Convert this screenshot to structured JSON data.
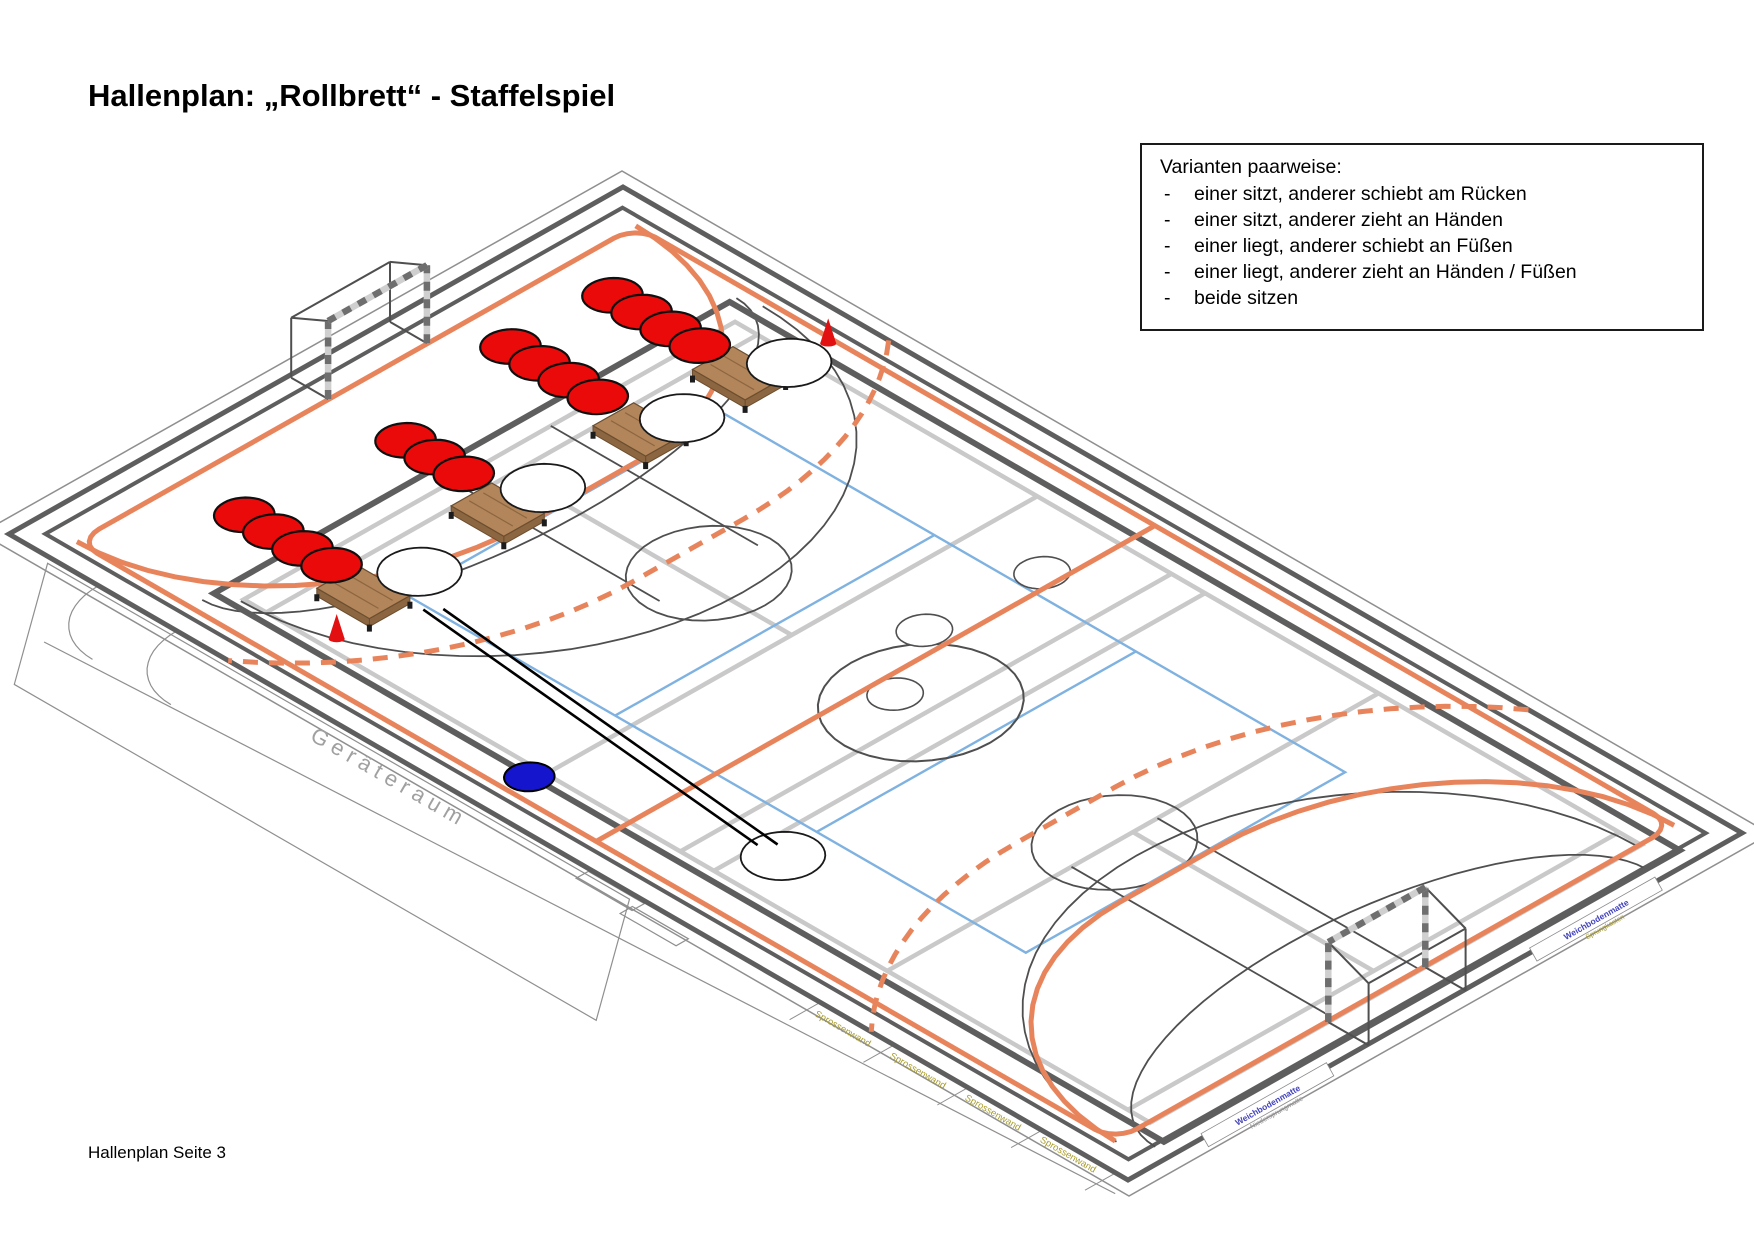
{
  "title": "Hallenplan: „Rollbrett“ - Staffelspiel",
  "footer": "Hallenplan Seite 3",
  "variants": {
    "title": "Varianten paarweise:",
    "items": [
      "einer sitzt, anderer schiebt am Rücken",
      "einer sitzt, anderer zieht an Händen",
      "einer liegt, anderer schiebt an Füßen",
      "einer liegt, anderer zieht an Händen / Füßen",
      "beide sitzen"
    ]
  },
  "labels": {
    "geraeteraum": "Geräteraum",
    "sprossenwand": "Sprossenwand",
    "right_wall": [
      {
        "main": "Weichbodenmatte",
        "sub": "Niedersprungmatte"
      },
      {
        "main": "Weichbodenmatte",
        "sub": "Sprungkasten"
      }
    ]
  },
  "scene": {
    "origin": [
      623,
      187
    ],
    "axis_u": [
      1119,
      646
    ],
    "axis_v": [
      -614,
      347
    ],
    "colors": {
      "wall": "#5E5E5E",
      "thin_outline": "#8F8F8F",
      "court_gray": "#C9C9C9",
      "court_blue": "#7FB2E0",
      "bball": "#4F4F4F",
      "handball": "#E8845C",
      "field": "#5E5E5E",
      "red": "#EA0A0A",
      "dot_stroke": "#101010",
      "wood": "#B3855A",
      "wood_dark": "#8C6640",
      "wood_line": "#6B4E30",
      "cone": "#E21010",
      "ball": "#1515CD",
      "board_fill": "#FFFFFF",
      "board_stroke": "#1A1A1A",
      "label_gray": "#A0A0A0",
      "label_olive": "#A89B2A",
      "label_blue": "#4343BE",
      "stripe_light": "#CFCFCF",
      "stripe_dark": "#6E6E6E",
      "arrow": "#000000"
    },
    "building": {
      "outer_rect": [
        -0.013,
        -0.022,
        1.013,
        1.022
      ],
      "band_line": [
        [
          0.1,
          1.125
        ],
        [
          1.005,
          1.03
        ]
      ],
      "room": [
        [
          0.04,
          1.01
        ],
        [
          0.56,
          1.01
        ],
        [
          0.64,
          1.21
        ],
        [
          0.12,
          1.21
        ]
      ],
      "door_arcs": [
        {
          "c": [
            0.135,
            1.0
          ],
          "ru": 0.055,
          "rv": 0.11
        },
        {
          "c": [
            0.205,
            1.0
          ],
          "ru": 0.055,
          "rv": 0.11
        }
      ],
      "mats": [
        [
          0.545,
          1.004,
          0.05,
          0.02
        ],
        [
          0.592,
          1.018,
          0.05,
          0.02
        ]
      ],
      "dividers_u": [
        0.725,
        0.791,
        0.857,
        0.923,
        0.989
      ],
      "divider_v": [
        1.0,
        1.05
      ]
    },
    "walls": {
      "outer": [
        0,
        0,
        1,
        1
      ],
      "inner": [
        0.016,
        0.03,
        0.984,
        0.97
      ]
    },
    "field_rect": [
      0.137,
      0.076,
      0.986,
      0.916
    ],
    "handball": {
      "court": [
        0.036,
        0.045,
        0.964,
        0.955
      ],
      "corner_r": [
        0.018,
        0.036
      ],
      "center_u": 0.5,
      "r6u": 0.185,
      "r9u": 0.277,
      "rv9": 0.545,
      "zones": [
        {
          "gu": 0.036,
          "dir": 1,
          "fv": [
            0.374,
            0.555
          ]
        },
        {
          "gu": 0.964,
          "dir": -1,
          "fv": [
            0.452,
            0.61
          ]
        }
      ]
    },
    "gray_lines": {
      "rect": [
        0.155,
        0.1,
        0.965,
        0.9
      ],
      "ulines": [
        0.175,
        0.425,
        0.545,
        0.575,
        0.73,
        0.945
      ],
      "vmid_segments": [
        [
          0.175,
          0.425
        ],
        [
          0.73,
          0.945
        ]
      ],
      "vmid": 0.5
    },
    "blue_court": {
      "rect": [
        0.223,
        0.24,
        0.777,
        0.76
      ],
      "ulines": [
        0.41,
        0.59
      ]
    },
    "basketball": {
      "center_big": {
        "c": [
          0.535,
          0.49
        ],
        "ru": 0.062,
        "rv": 0.124
      },
      "small_circles": [
        [
          0.487,
          0.205
        ],
        [
          0.48,
          0.384
        ],
        [
          0.517,
          0.499
        ]
      ],
      "small_r": [
        0.017,
        0.034
      ],
      "keys": [
        {
          "base": 0.155,
          "v": [
            0.4,
            0.56
          ],
          "front": 0.34,
          "ft": [
            0.34,
            0.48
          ]
        },
        {
          "base": 0.965,
          "v": [
            0.46,
            0.6
          ],
          "front": 0.73,
          "ft": [
            0.73,
            0.53
          ]
        }
      ],
      "ft_r": [
        0.05,
        0.1
      ],
      "arcs": [
        {
          "c": [
            0.137,
            0.5
          ],
          "ru": 0.1,
          "rv": 0.435,
          "bulge": 1
        },
        {
          "c": [
            0.986,
            0.53
          ],
          "ru": 0.1,
          "rv": 0.4,
          "bulge": -1
        },
        {
          "c": [
            0.155,
            0.48
          ],
          "ru": 0.215,
          "rv": 0.425,
          "bulge": 1
        },
        {
          "c": [
            0.965,
            0.53
          ],
          "ru": 0.215,
          "rv": 0.425,
          "bulge": -1
        }
      ]
    },
    "queues": [
      {
        "v": 0.163,
        "u": [
          0.08,
          0.106,
          0.132,
          0.158
        ]
      },
      {
        "v": 0.32,
        "u": [
          0.075,
          0.101,
          0.127,
          0.153
        ]
      },
      {
        "v": 0.54,
        "u": [
          0.102,
          0.128,
          0.154
        ]
      },
      {
        "v": 0.779,
        "u": [
          0.089,
          0.115,
          0.141,
          0.167
        ]
      }
    ],
    "dot_r": [
      0.0185,
      0.036
    ],
    "benches": [
      [
        0.197,
        0.17
      ],
      [
        0.197,
        0.332
      ],
      [
        0.197,
        0.563
      ],
      [
        0.202,
        0.791
      ]
    ],
    "bench_half": [
      0.0235,
      0.033
    ],
    "boards": [
      [
        0.211,
        0.114
      ],
      [
        0.207,
        0.281
      ],
      [
        0.2,
        0.495
      ],
      [
        0.211,
        0.716
      ],
      [
        0.594,
        0.822
      ]
    ],
    "board_r": [
      0.026,
      0.05
    ],
    "cones": [
      [
        0.213,
        0.054
      ],
      [
        0.227,
        0.88
      ]
    ],
    "ball": {
      "c": [
        0.42,
        0.918
      ],
      "r": [
        0.0155,
        0.03
      ]
    },
    "arrows": {
      "a": [
        0.585,
        0.82
      ],
      "b": [
        0.24,
        0.757
      ],
      "offset": 6
    },
    "goals": [
      {
        "u": 0.0355,
        "v1": 0.384,
        "v2": 0.545,
        "h": 78,
        "bdu": -0.033,
        "bh": 60
      },
      {
        "u": 0.965,
        "v1": 0.452,
        "v2": 0.61,
        "h": 80,
        "bdu": 0.036,
        "bh": 62
      }
    ],
    "wall_texts": {
      "geraeteraum": {
        "pos": [
          0.362,
          1.046
        ],
        "rot": 30,
        "size": 22,
        "spacing": 6
      },
      "sprossenwand": {
        "positions": [
          [
            0.757,
            1.024
          ],
          [
            0.823,
            1.022
          ],
          [
            0.889,
            1.02
          ],
          [
            0.955,
            1.018
          ]
        ],
        "rot": 30,
        "size": 9.5
      },
      "right_wall": {
        "positions": [
          [
            1.005,
            0.78
          ],
          [
            1.005,
            0.245
          ]
        ],
        "rot": -29.5,
        "size": 8.5
      }
    }
  }
}
